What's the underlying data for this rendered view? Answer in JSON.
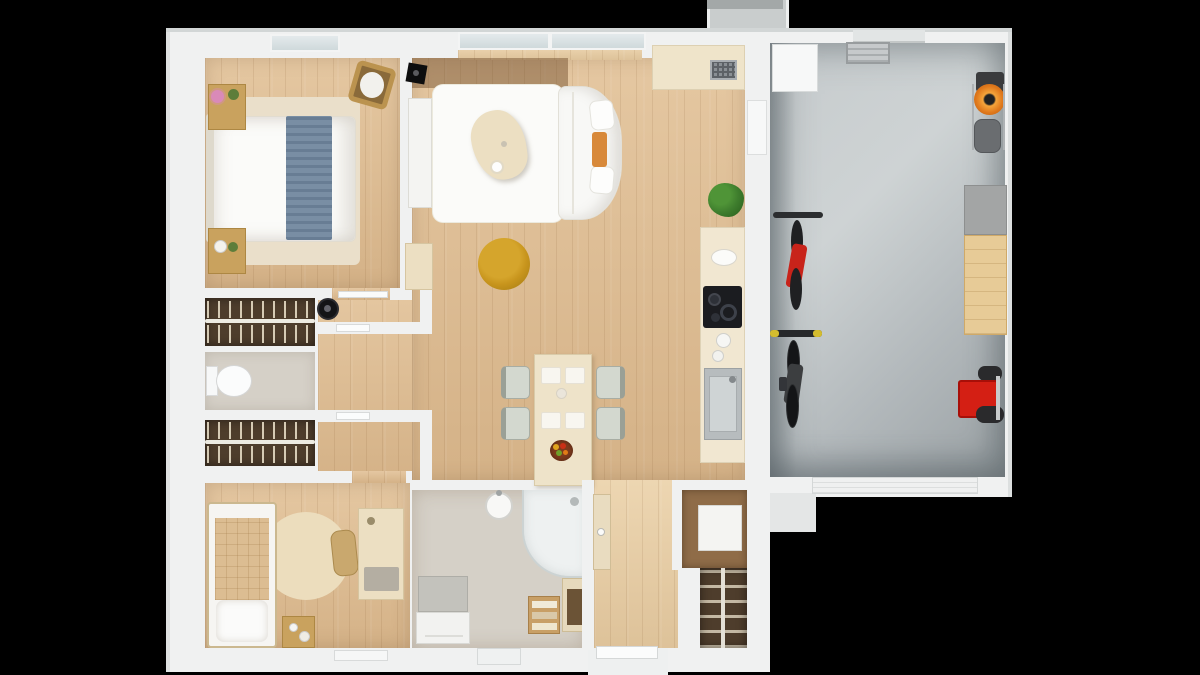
{
  "meta": {
    "title": "3D top-down floor plan render of a house with attached garage",
    "canvas": {
      "width": 1200,
      "height": 675
    },
    "visible_text": "none"
  },
  "palette": {
    "bg": "#000000",
    "wall": "#f0f1f1",
    "wall-dim": "#e2e5e5",
    "wood": "#dfbd92",
    "wood-light": "#e9cfa6",
    "wood-dark": "#b7926b",
    "walnut": "#4e3d2c",
    "greige": "#d5d0c7",
    "cream": "#efe4ca",
    "cream-furn": "#ecdfc2",
    "white-furn": "#f8f8f6",
    "garage-dark": "#9aa1a4",
    "rug-beige": "#eadfca",
    "rug-white": "#fbfbf9",
    "blue-throw": "#72889f",
    "tan": "#c9a25e",
    "pouf-yellow": "#c8951d",
    "mower-orange": "#e0791c",
    "cart-red": "#d41f14",
    "bike-red": "#c8231a",
    "plant-green": "#3e7d2d",
    "cooktop-black": "#1b1c20",
    "steel": "#b7bcbe",
    "grip-yellow": "#d4bc2e",
    "chair-sage": "#d3d8cf"
  },
  "rooms": [
    {
      "name": "bedroom-1",
      "floor": "wood",
      "furniture": [
        "double-bed-white-duvet",
        "blue-throw-blanket",
        "beige-rug",
        "nightstand-with-flowers-top",
        "nightstand-with-plant-bottom",
        "laundry-basket",
        "wall-tv"
      ]
    },
    {
      "name": "living-dining-kitchen",
      "floor": "wood",
      "furniture": [
        "white-rug",
        "corner-sofa",
        "sofa-pillows",
        "orange-armrest-tray",
        "triangular-coffee-table",
        "yellow-pouf",
        "tv-console",
        "corner-cabinet",
        "dining-table",
        "dining-chairs-x4",
        "placemats-x4",
        "fruit-bowl",
        "potted-plant"
      ]
    },
    {
      "name": "kitchen-counters",
      "floor": "wood",
      "furniture": [
        "upper-counter-with-grille-appliance",
        "counter-strip",
        "bread-board",
        "induction-cooktop-with-pots",
        "kettle",
        "steel-sink"
      ]
    },
    {
      "name": "walk-in-closet-top",
      "floor": "walnut",
      "furniture": [
        "hanger-row-x2",
        "robot-vacuum"
      ]
    },
    {
      "name": "wc",
      "floor": "greige",
      "furniture": [
        "toilet"
      ]
    },
    {
      "name": "walk-in-closet-bottom",
      "floor": "walnut",
      "furniture": [
        "hanger-row-x2"
      ]
    },
    {
      "name": "bedroom-2",
      "floor": "wood",
      "furniture": [
        "single-bed-tan-blanket",
        "round-rug",
        "desk",
        "desk-chair",
        "side-table"
      ]
    },
    {
      "name": "bathroom",
      "floor": "greige",
      "furniture": [
        "walk-in-shower",
        "round-basin",
        "gray-vanity",
        "washer",
        "towel-shelf",
        "stool",
        "laundry-cabinet"
      ]
    },
    {
      "name": "hall-entry",
      "floor": "wood",
      "furniture": [
        "tall-cabinet",
        "utility-closet-with-heater",
        "shoe-rack",
        "entry-door"
      ]
    },
    {
      "name": "garage",
      "floor": "concrete",
      "furniture": [
        "white-cabinet",
        "creeper-shelf",
        "lawn-mower-orange",
        "red-bike",
        "black-bike-yellow-grips",
        "gray-cabinet",
        "wood-workbench",
        "red-tool-cart",
        "garage-door-bottom",
        "wall-tool"
      ]
    }
  ],
  "exterior": [
    "top-porch-block",
    "entry-stoop-bottom",
    "garage-side-stoop",
    "garage-door-opening"
  ]
}
